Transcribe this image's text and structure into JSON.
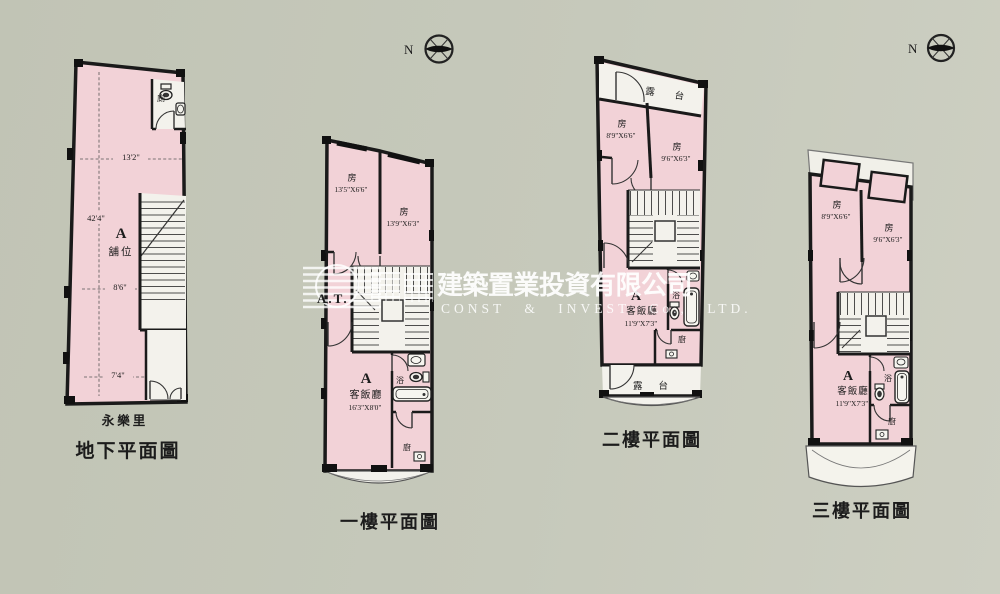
{
  "watermark": {
    "logo_text": "A.T.",
    "company_cn": "建築置業投資有限公司",
    "company_en": "CONST & INVEST Co., LTD."
  },
  "compass": {
    "label": "N"
  },
  "plans": {
    "basement": {
      "street": "永樂里",
      "title": "地下平面圖",
      "unit": "A",
      "unit_type": "舖位",
      "toilet": "廁",
      "dim_top": "13'2\"",
      "dim_left": "42'4\"",
      "dim_mid": "8'6\"",
      "dim_bottom": "7'4\""
    },
    "floor1": {
      "title": "一樓平面圖",
      "unit": "A",
      "room1": {
        "label": "房",
        "dims": "13'5\"X6'6\""
      },
      "room2": {
        "label": "房",
        "dims": "13'9\"X6'3\""
      },
      "living": {
        "label": "客飯廳",
        "dims": "16'3\"X8'0\""
      },
      "bath": "浴",
      "kitchen": "廚"
    },
    "floor2": {
      "title": "二樓平面圖",
      "unit": "A",
      "terrace_top": "露台",
      "terrace_bottom": "露台",
      "room1": {
        "label": "房",
        "dims": "8'9\"X6'6\""
      },
      "room2": {
        "label": "房",
        "dims": "9'6\"X6'3\""
      },
      "living": {
        "label": "客飯廳",
        "dims": "11'9\"X7'3\""
      },
      "bath": "浴",
      "kitchen": "廚"
    },
    "floor3": {
      "title": "三樓平面圖",
      "unit": "A",
      "room1": {
        "label": "房",
        "dims": "8'9\"X6'6\""
      },
      "room2": {
        "label": "房",
        "dims": "9'6\"X6'3\""
      },
      "living": {
        "label": "客飯廳",
        "dims": "11'9\"X7'3\""
      },
      "bath": "浴",
      "kitchen": "廚"
    }
  }
}
